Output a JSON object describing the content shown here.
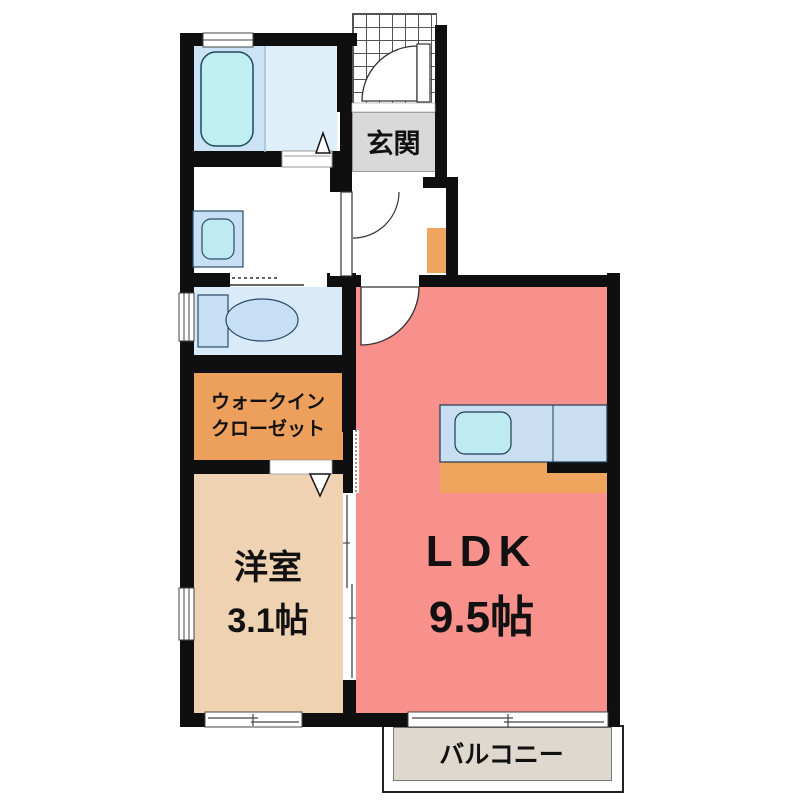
{
  "title": "1LDK apartment floor plan",
  "labels": {
    "entrance": "玄関",
    "walk_in_closet_line1": "ウォークイン",
    "walk_in_closet_line2": "クローゼット",
    "western_room_name": "洋室",
    "western_room_size": "3.1帖",
    "ldk_name": "LDK",
    "ldk_size": "9.5帖",
    "balcony": "バルコニー"
  },
  "colors": {
    "wall": "#0f0f0f",
    "text": "#111111",
    "ldk_floor": "#F8908C",
    "western_floor": "#EFD2B2",
    "closet_floor": "#EDA05B",
    "kitchen_floor": "#F0A55F",
    "bath_zone": "#CBE3F5",
    "bath_washing": "#DEEFFA",
    "tub": "#BFEFF2",
    "toilet_floor": "#D9EAF8",
    "fixture_blue": "#C7DFF4",
    "fixture_cyan": "#BEEAF2",
    "counter_blue": "#C9DEF3",
    "genkan_gray": "#D9D9D9",
    "balcony_floor": "#DFD8CE"
  }
}
